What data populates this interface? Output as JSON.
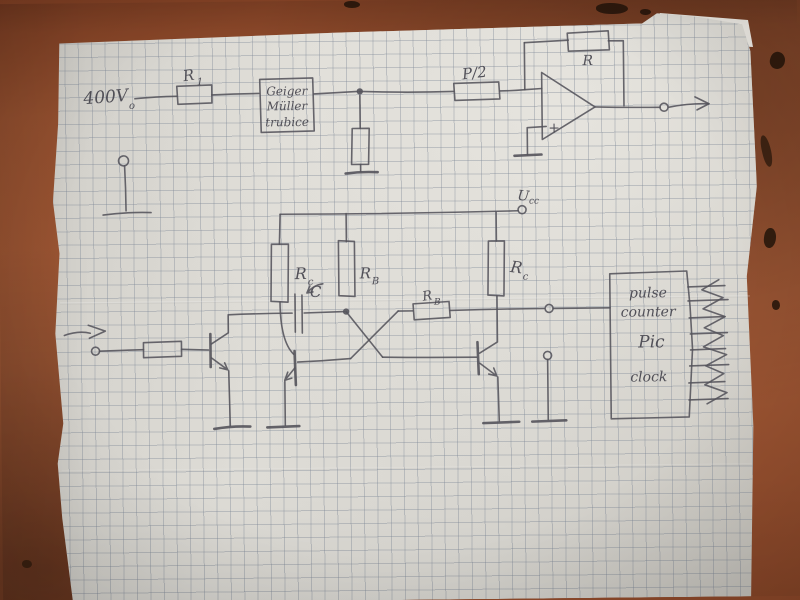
{
  "schematic": {
    "supply": {
      "base": "400V",
      "sub": "o"
    },
    "r1": {
      "base": "R",
      "sub": "1"
    },
    "gm_box": {
      "line1": "Geiger",
      "line2": "Müller",
      "line3": "trubice"
    },
    "p_half": "P/2",
    "feedback_r": "R",
    "opamp": {
      "plus": "+"
    },
    "ucc": {
      "base": "U",
      "sub": "cc"
    },
    "rc_left": {
      "base": "R",
      "sub": "c"
    },
    "rb_top": {
      "base": "R",
      "sub": "B"
    },
    "rc_right": {
      "base": "R",
      "sub": "c"
    },
    "cap": "C",
    "rb_coupling": {
      "base": "R",
      "sub": "B"
    },
    "counter": {
      "line1": "pulse",
      "line2": "counter",
      "line3": "Pic",
      "line4": "clock"
    }
  }
}
